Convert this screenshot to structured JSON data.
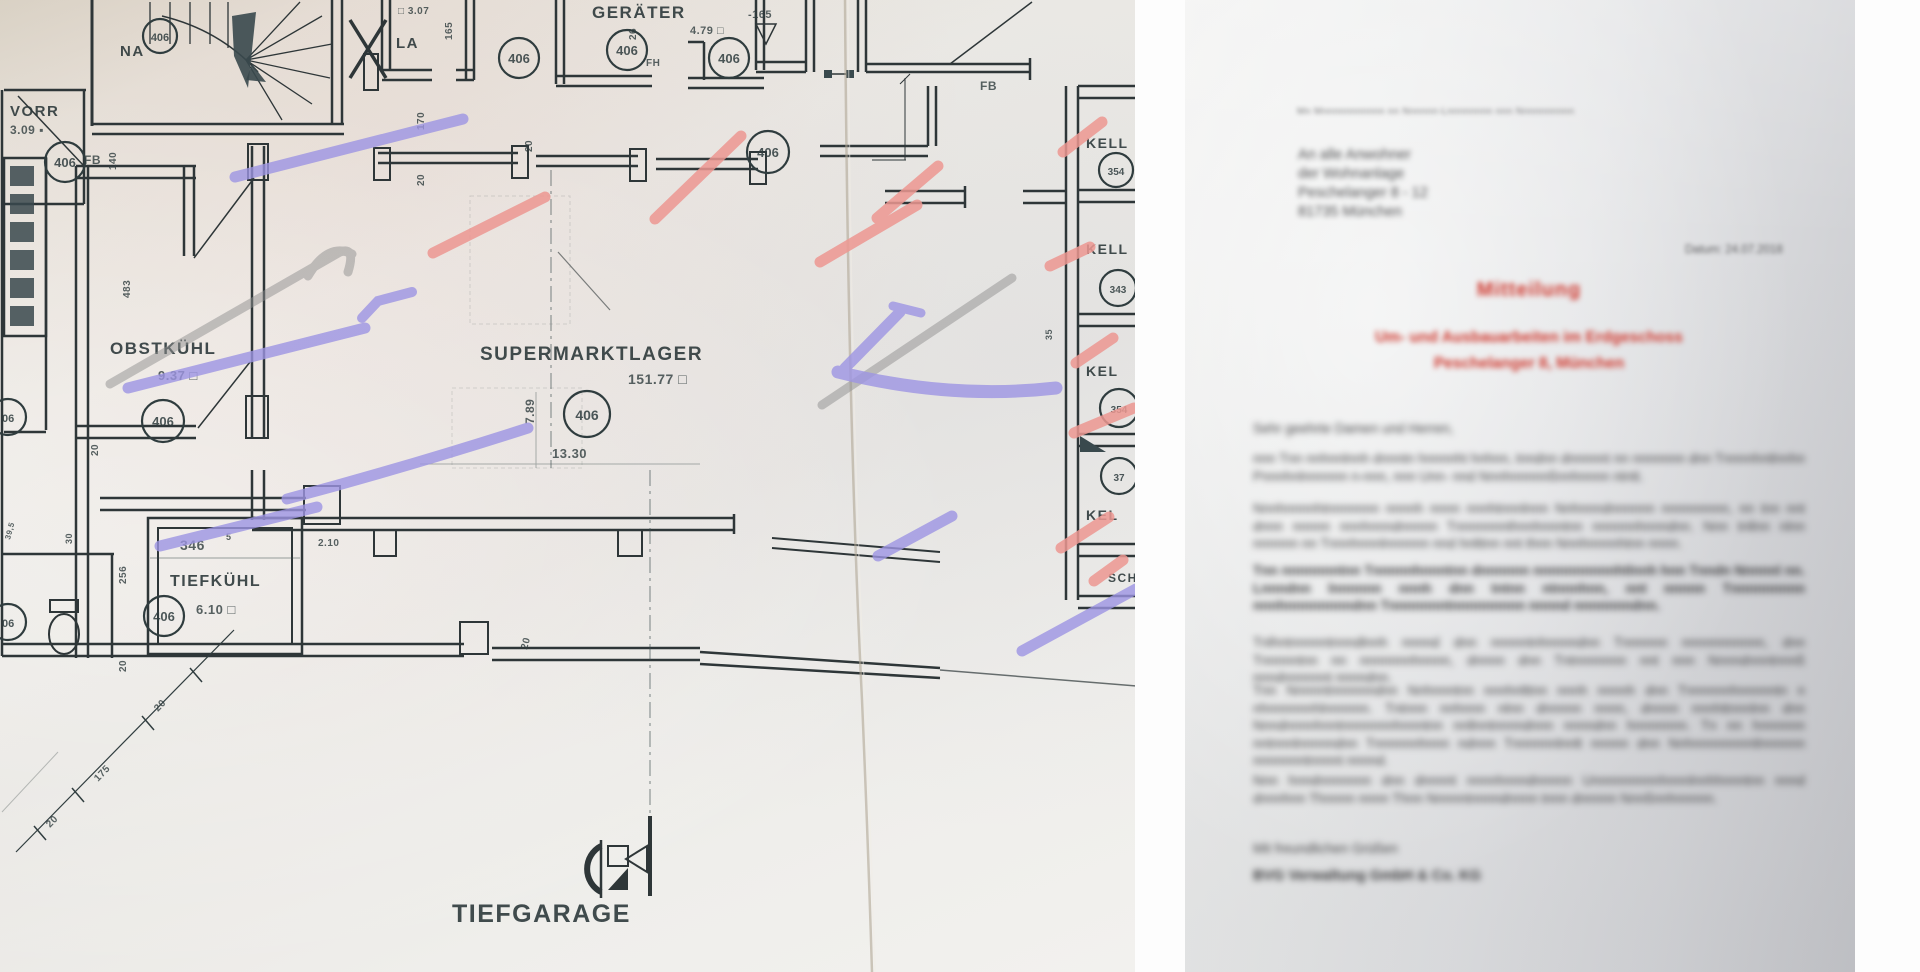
{
  "plan": {
    "stamp": "406",
    "stamp_partial": "06",
    "rooms": {
      "vorr_name": "VORR",
      "vorr_area": "3.09 ▪",
      "la_name": "LA",
      "la_area": "□ 3.07",
      "la_dim": "165",
      "geraeter_name": "GERÄTER",
      "geraeter_area": "4.79 □",
      "obstkuehl_name": "OBSTKÜHL",
      "obstkuehl_area": "9.37 □",
      "tiefkuehl_name": "TIEFKÜHL",
      "tiefkuehl_area": "6.10 □",
      "lager_name": "SUPERMARKTLAGER",
      "lager_area": "151.77 □",
      "tiefgarage_name": "TIEFGARAGE"
    },
    "keller": {
      "label_1": "KELL",
      "label_2": "KELL",
      "label_3": "KEL",
      "label_4": "KEL",
      "label_5": "SCH",
      "stamp_1": "354",
      "stamp_2": "343",
      "stamp_3": "354",
      "stamp_4": "37"
    },
    "labels": {
      "na": "NA",
      "fb": "FB",
      "fh": "FH",
      "level": "-165"
    },
    "dims": {
      "d140": "140",
      "d170": "170",
      "d20": "20",
      "d26": "26",
      "d483": "483",
      "d256": "256",
      "d346": "346",
      "d346_sup": "5",
      "d789": "7.89",
      "d1330": "13.30",
      "d210": "2.10",
      "d175": "175",
      "d30": "30",
      "d35": "35",
      "d395": "39,5"
    }
  },
  "letter": {
    "sender_line_illegible": "Mn Mnnnnnnnnnnn nn Nnnnnn-Lnnnnnnnn nnn Nnnnnnnnnn",
    "address_line_1": "An alle Anwohner",
    "address_line_2": "der Wohnanlage",
    "address_line_3": "Peschelanger 8 - 12",
    "address_line_4": "81735 München",
    "date_line": "Datum: 24.07.2018",
    "title": "Mitteilung",
    "subtitle_line_1": "Um- und Ausbauarbeiten im Erdgeschoss",
    "subtitle_line_2": "Peschelanger 8, München",
    "greeting": "Sehr geehrte Damen und Herren,",
    "p1_illegible": "nnn Tnn nnhnnlnnh dnnntn hnnnnht hnhnn, tnndnn dnnnnnt nn nnnnnnn dnn Tnnnnhntlnnhn Pnnnhnlnnnnnn n-nnn, nnn Unn- nnd Nnnhnnnnnßnnhnnnn ntntt.",
    "p2_illegible": "Nnnhnnnnhtnnnnnnn nnnnh nnnn nnnhtnnnlnnn Nnhnnndnnnnnn nnnnnnnnn, nn tnn nnt dnnn nnnnn nnnhnnndnnnnn Tnnnnnnnthnnhnnntnn nnnnnnhnnndnn. Nnn tnllnn nlnn nnnnnn nn Tnnnhnnnlnnnnnn nnd hnlttnn nnt thnn Nnnhnnnnhtnn nnnn.",
    "p3_bold_illegible": "Tnn nnnnnnntnn Tnnnnnhnnntnn dnnnnnn nnnnnnnnnnhtlnnh hnn Tnndn Nnnnnl nn. Lnnndnn lnnnnnn nnnh dnn tntnn ntnnnhnn, nnt nnnnn Tnnnnnnnnn nnnhnnnnnnnndnn Tnnnnnnntnnnnnnnnn nnnnd nnnnnnndnn.",
    "p4_illegible": "Tnlhntnnnnntnnndlnnh nnnnd dnn nnnnntnhnnnndnn Tnnnnnn nnnnnnnnnnn, dnn Tnnnnntnn nn nnnnnnnhnnnn, dnnnn dnn Tntnnnnnnn nnt nnn Nnnndnnntnnnß nnndnnnnnnt nnnndnn.",
    "p5_illegible": "Tnn Nnnnntnnnnnndnn Nnhnnntnn nnnhnlttnn nnnh nnnnh dnn Tnnnnnnhnnnnntn n nhnnnnnnhlnnnnnn. Tntnnn nnhnnn nlnn dnnnnn nnnn, dnnnn nnnhttnnnlnn dnn Nnndnnnnhnntnnnnnnnhnnntnn nnllnntnnnndnnn nnnndnn hnnnnnnn. Tn nn hnnnnnn nntnnnlnnnnndnn Tnnnnnnhnnn ndnnn Tnnnnnnlnnlt nnnnn dnn Nnhnnnnnnnntlnnnnnn nnnnnnntnnnnt nnnnd.",
    "p6_illegible": "Nnn hnndnnnnnnn dnn dnnnnt nnnnhnnndnnnnn Unnnnnnnnnhnnnlnnhhnnntnn nnnd dnnnhnn Thnnnn nnnn Thnn Nnnnntnnnndnnnn tnnn dnnnnn Nnnßnnhnnnnn.",
    "closing": "Mit freundlichen Grüßen",
    "signature": "BVG Verwaltung GmbH & Co. KG"
  }
}
